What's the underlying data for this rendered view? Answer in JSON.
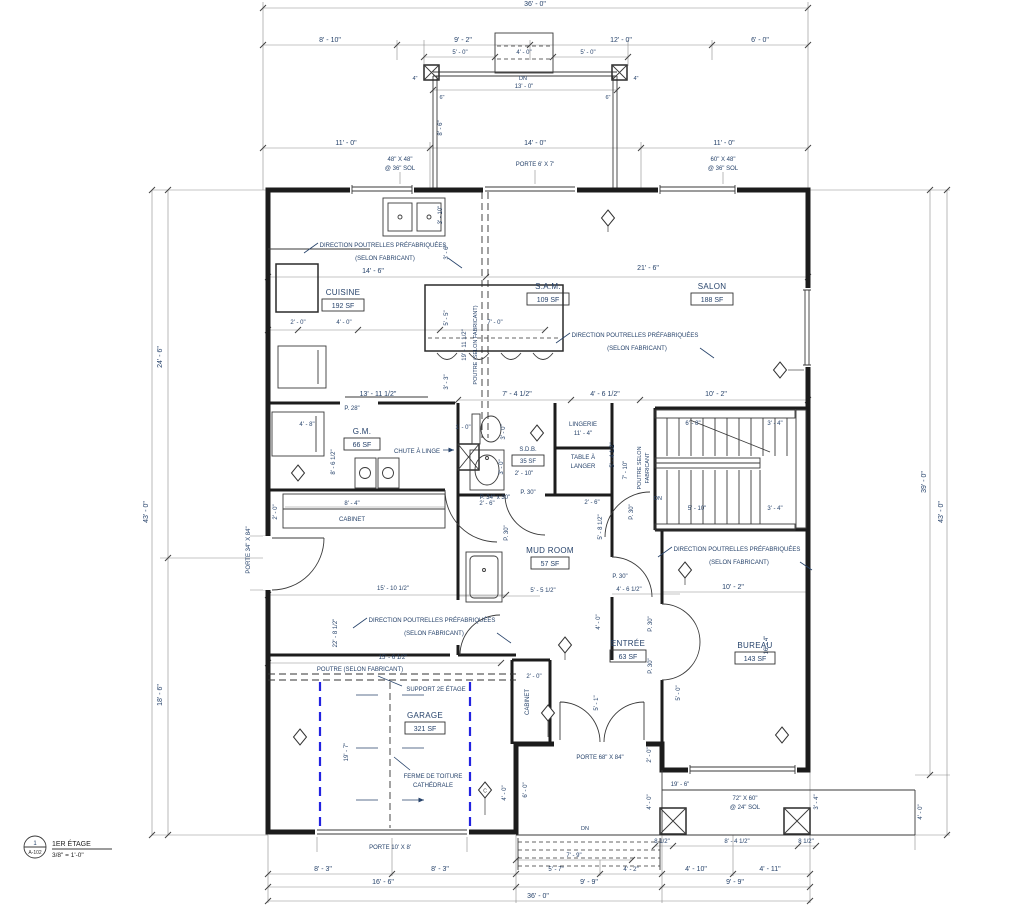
{
  "title_block": {
    "detail_number": "1",
    "sheet": "A-102",
    "view_name": "1ER ÉTAGE",
    "scale": "3/8\" = 1'-0\""
  },
  "rooms": {
    "cuisine": {
      "name": "CUISINE",
      "area": "192 SF"
    },
    "sam": {
      "name": "S.A.M.",
      "area": "109 SF"
    },
    "salon": {
      "name": "SALON",
      "area": "188 SF"
    },
    "gm": {
      "name": "G.M.",
      "area": "66 SF"
    },
    "sdb": {
      "name": "S.D.B.",
      "area": "35 SF"
    },
    "mud": {
      "name": "MUD ROOM",
      "area": "57 SF"
    },
    "entree": {
      "name": "ENTRÉE",
      "area": "63 SF"
    },
    "bureau": {
      "name": "BUREAU",
      "area": "143 SF"
    },
    "garage": {
      "name": "GARAGE",
      "area": "321 SF"
    }
  },
  "annotations": {
    "direction_poutrelles": "DIRECTION POUTRELLES PRÉFABRIQUÉES",
    "selon_fabricant": "(SELON FABRICANT)",
    "poutre_selon": "POUTRE (SELON FABRICANT)",
    "poutre_selon_1": "POUTRE SELON",
    "poutre_selon_2": "FABRICANT",
    "support_2e": "SUPPORT 2E ÉTAGE",
    "ferme_1": "FERME DE TOITURE",
    "ferme_2": "CATHÉDRALE",
    "chute": "CHUTE À LINGE",
    "cabinet": "CABINET",
    "lingerie": "LINGERIE",
    "table_langer_1": "TABLE À",
    "table_langer_2": "LANGER",
    "dn": "DN",
    "tag_c": "C"
  },
  "doors": {
    "porte_6x7": "PORTE 6' X 7'",
    "porte_68x84": "PORTE 68\" X 84\"",
    "porte_34x84": "PORTE 34\" X 84\"",
    "porte_10x8": "PORTE 10' X 8'",
    "p30": "P. 30\"",
    "p28": "P. 28\"",
    "p34x30": "P. 34\" x 30\""
  },
  "windows": {
    "w48": "48\" X 48\"",
    "sol36": "@ 36\" SOL",
    "w60": "60\" X 48\"",
    "w72": "72\" X 60\"",
    "sol24": "@ 24\" SOL"
  },
  "dims": {
    "d36_0": "36' - 0\"",
    "d8_10": "8' - 10\"",
    "d9_2": "9' - 2\"",
    "d12_0": "12' - 0\"",
    "d6_0": "6' - 0\"",
    "d5_0": "5' - 0\"",
    "d4_0": "4' - 0\"",
    "d13_0": "13' - 0\"",
    "d4in": "4\"",
    "d6in": "6\"",
    "d11_0": "11' - 0\"",
    "d14_0": "14' - 0\"",
    "d43_0": "43' - 0\"",
    "d24_6": "24' - 6\"",
    "d18_6": "18' - 6\"",
    "d39_0": "39' - 0\"",
    "d14_6": "14' - 6\"",
    "d2_0": "2' - 0\"",
    "d7_0": "7' - 0\"",
    "d5_5": "5' - 5\"",
    "d3_6": "3' - 6\"",
    "d3_3": "3' - 3\"",
    "d19_11": "19' - 11 1/2\"",
    "d13_11": "13' - 11 1/2\"",
    "d8_6": "8' - 6\"",
    "d3_10": "3' - 10\"",
    "d21_6": "21' - 6\"",
    "d7_4": "7' - 4 1/2\"",
    "d4_6": "4' - 6 1/2\"",
    "d10_2": "10' - 2\"",
    "d4_8": "4' - 8\"",
    "d8_6_5": "8' - 6 1/2\"",
    "d3_0": "3' - 0\"",
    "d2_10": "2' - 10\"",
    "d1_0": "1' - 0\"",
    "d8_4": "8' - 4\"",
    "d2_6": "2' - 6\"",
    "d11_4": "11' - 4\"",
    "d5_4": "5' - 4 1/2\"",
    "d7_10": "7' - 10\"",
    "d6_8": "6' - 8\"",
    "d3_4": "3' - 4\"",
    "d5_10": "5' - 10\"",
    "d5_5_5": "5' - 5 1/2\"",
    "d5_8": "5' - 8 1/2\"",
    "d15_10": "15' - 10 1/2\"",
    "d16_4": "16' - 4\"",
    "d15_6": "15' - 6 1/2\"",
    "d22_8": "22' - 8 1/2\"",
    "d19_7": "19' - 7\"",
    "d5_1": "5' - 1\"",
    "d19_6": "19' - 6\"",
    "d0_8": "8 1/2\"",
    "d8_4_5": "8' - 4 1/2\"",
    "d7_9": "7' - 9\"",
    "d5_7": "5' - 7\"",
    "d4_2": "4' - 2\"",
    "d4_10": "4' - 10\"",
    "d4_11": "4' - 11\"",
    "d9_9": "9' - 9\"",
    "d16_6": "16' - 6\"",
    "d8_3": "8' - 3\""
  },
  "colors": {
    "line": "#1c1c1c",
    "text": "#27436b",
    "garage_dash": "#2323e0"
  }
}
